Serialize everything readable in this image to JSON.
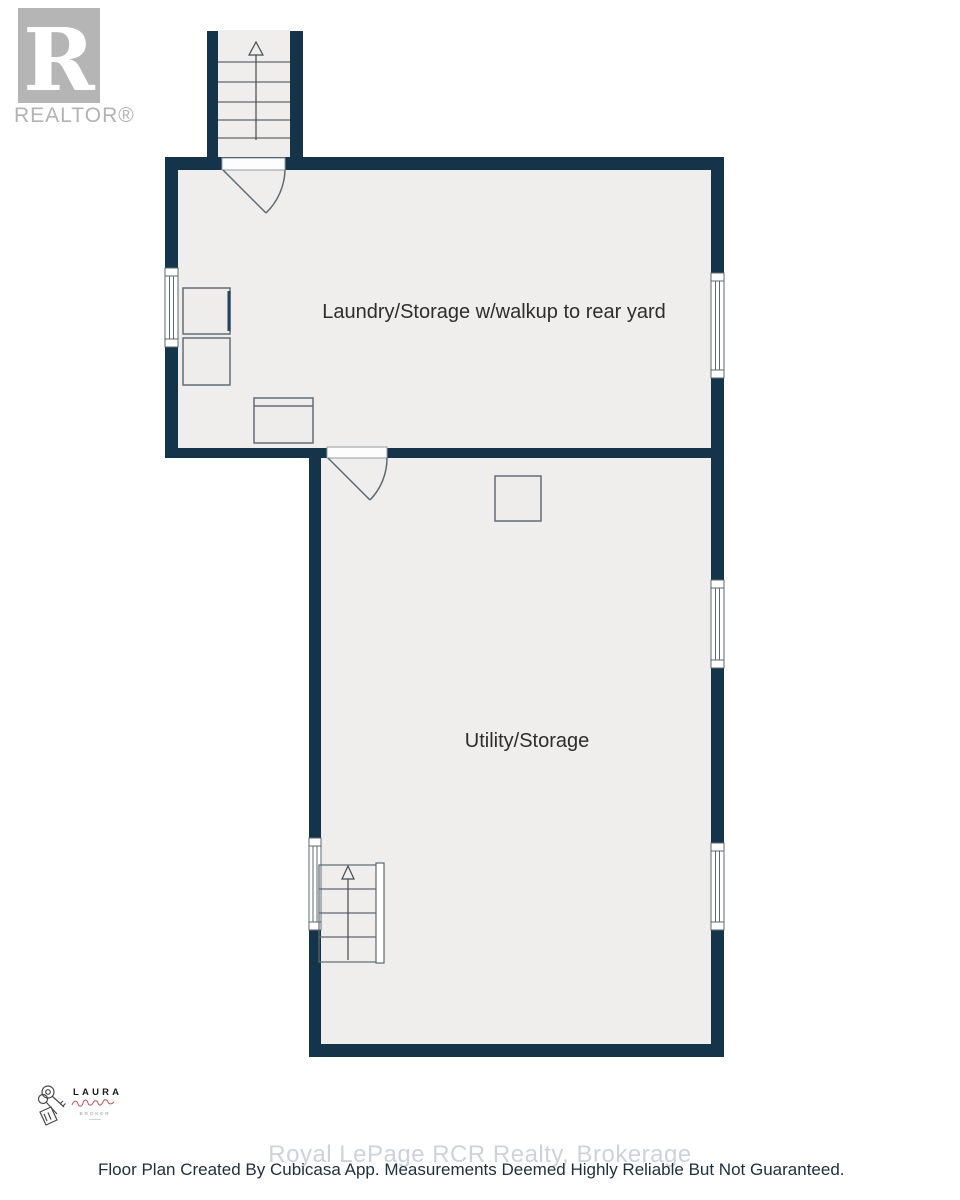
{
  "branding": {
    "realtor_logo_letter": "R",
    "realtor_label": "REALTOR®"
  },
  "agent_stamp": {
    "name": "LAURA",
    "title": "BROKER"
  },
  "floorplan": {
    "rooms": [
      {
        "label": "Laundry/Storage w/walkup to rear yard"
      },
      {
        "label": "Utility/Storage"
      }
    ]
  },
  "footer": {
    "watermark": "Royal LePage RCR Realty, Brokerage",
    "disclaimer": "Floor Plan Created By Cubicasa App. Measurements Deemed Highly Reliable But Not Guaranteed."
  },
  "colors": {
    "wall": "#163449",
    "floor": "#efeeec",
    "symbol_stroke": "#5d6972",
    "watermark_text": "#cdd3d8",
    "disclaimer_text": "#20303f",
    "realtor_gray": "#b5b5b5",
    "signature_red": "#c0504d"
  }
}
